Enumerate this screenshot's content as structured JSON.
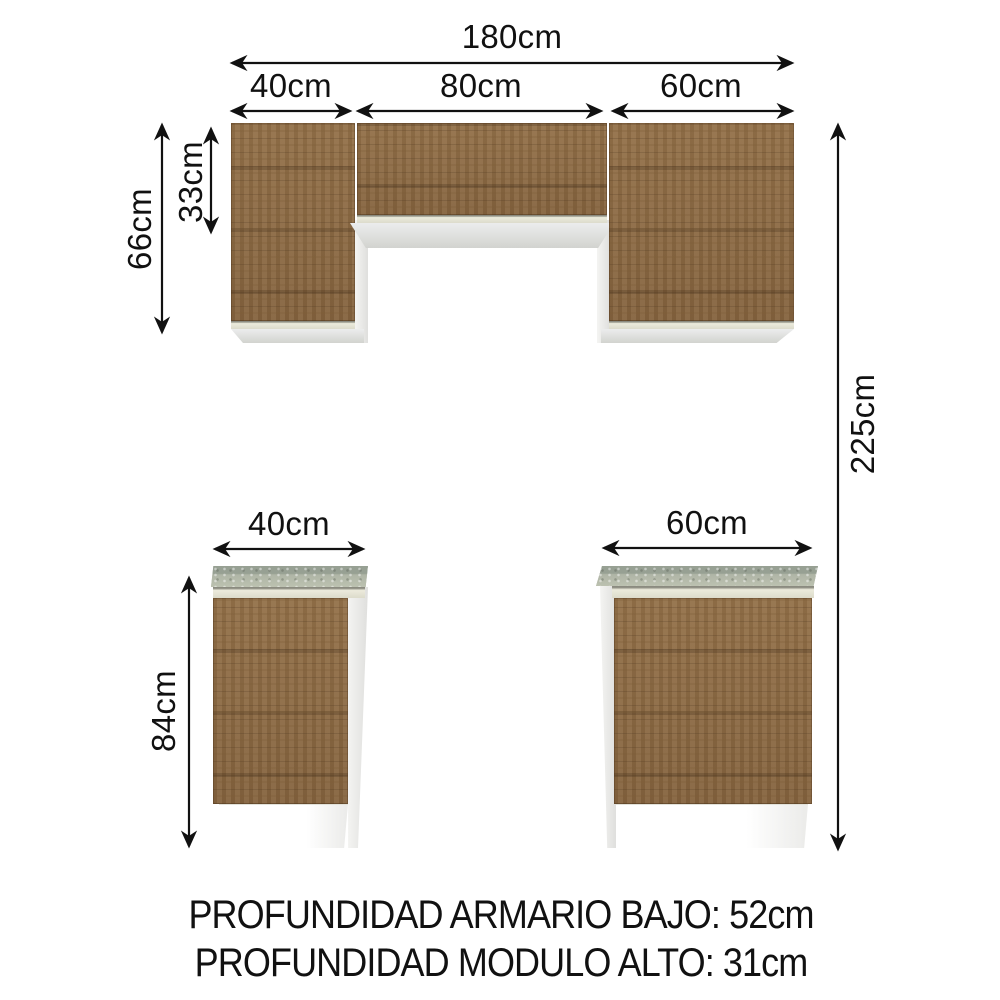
{
  "diagram": {
    "product": "kitchen-cabinet-dimension-diagram",
    "upper": {
      "total_width": "180cm",
      "left_width": "40cm",
      "middle_width": "80cm",
      "right_width": "60cm",
      "side_height": "66cm",
      "middle_height": "33cm"
    },
    "overall": {
      "total_height": "225cm"
    },
    "base": {
      "left_width": "40cm",
      "right_width": "60cm",
      "height": "84cm"
    },
    "notes": {
      "depth_base": "PROFUNDIDAD ARMARIO BAJO: 52cm",
      "depth_upper": "PROFUNDIDAD MODULO ALTO: 31cm"
    },
    "colors": {
      "wood": "#8d6b46",
      "countertop": "#b6bbac",
      "cabinet_body": "#ececea",
      "rail": "#ecebdc",
      "dimension_lines": "#111111",
      "background": "#ffffff"
    }
  }
}
